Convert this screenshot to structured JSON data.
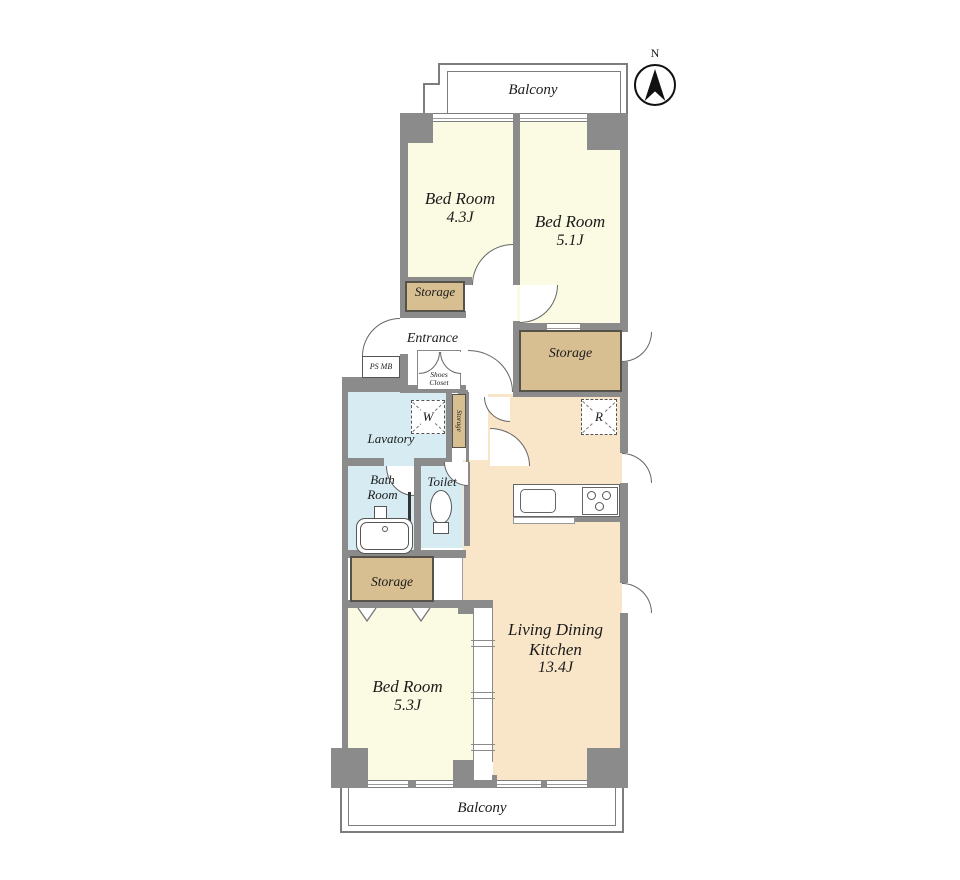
{
  "palette": {
    "wall": "#8b8b8b",
    "bedroom_fill": "#fbfae3",
    "ldk_fill": "#f9e5c8",
    "storage_fill": "#d8bf92",
    "wet_area_fill": "#d6ebf2"
  },
  "compass": {
    "north_label": "N"
  },
  "balconies": {
    "top": "Balcony",
    "bottom": "Balcony"
  },
  "rooms": {
    "bedroom_top_left": {
      "name": "Bed Room",
      "size": "4.3J"
    },
    "bedroom_top_right": {
      "name": "Bed Room",
      "size": "5.1J"
    },
    "bedroom_bottom": {
      "name": "Bed Room",
      "size": "5.3J"
    },
    "ldk": {
      "name_line1": "Living Dining",
      "name_line2": "Kitchen",
      "size": "13.4J"
    },
    "entrance": {
      "name": "Entrance"
    },
    "lavatory": {
      "name": "Lavatory"
    },
    "bath": {
      "name_line1": "Bath",
      "name_line2": "Room"
    },
    "toilet": {
      "name": "Toilet"
    }
  },
  "storage": {
    "top_left": "Storage",
    "right": "Storage",
    "hall_small": "Storage",
    "bottom_left": "Storage"
  },
  "labels": {
    "ps_mb": "PS MB",
    "shoes_line1": "Shoes",
    "shoes_line2": "Closet",
    "washer": "W",
    "fridge": "R"
  }
}
